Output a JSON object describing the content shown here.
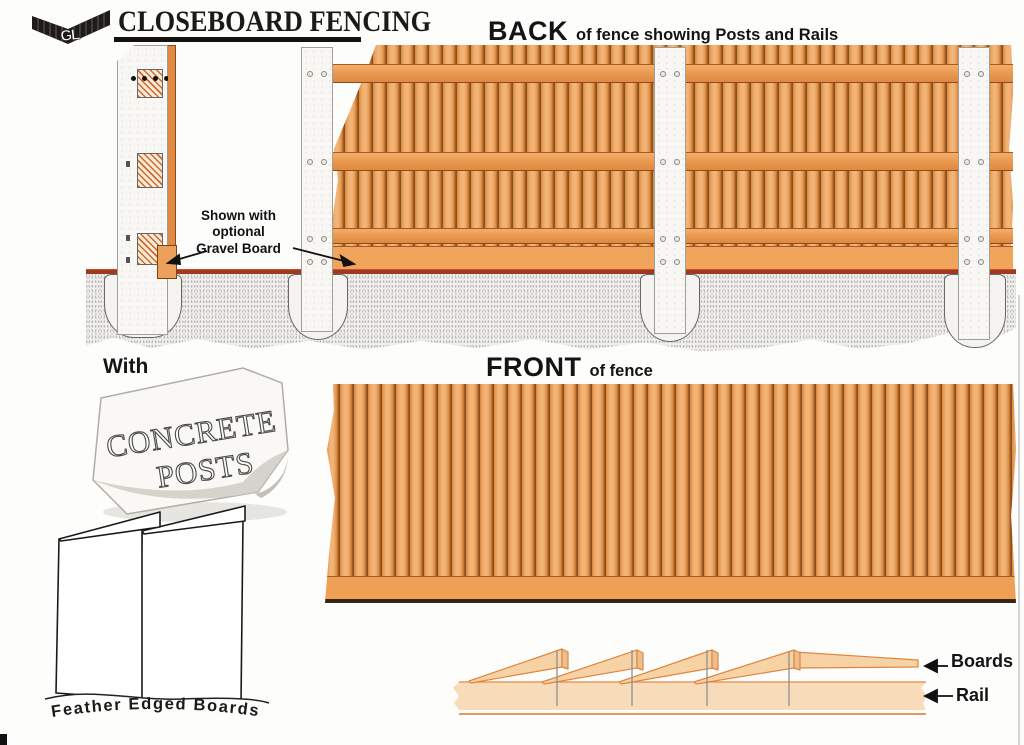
{
  "page": {
    "title": "CLOSEBOARD FENCING",
    "logo_monogram": "GL"
  },
  "back": {
    "heading": "BACK",
    "heading_rest": "of fence showing Posts and Rails",
    "annotation": {
      "line1": "Shown with",
      "line2": "optional",
      "line3": "Gravel Board"
    }
  },
  "front": {
    "heading": "FRONT",
    "heading_rest": "of fence"
  },
  "posts": {
    "with_label": "With",
    "block_line1": "CONCRETE",
    "block_line2": "POSTS"
  },
  "feather": {
    "caption": "Feather Edged Boards"
  },
  "detail": {
    "boards_label": "Boards",
    "rail_label": "Rail"
  },
  "colors": {
    "board_orange": "#E2954D",
    "rail_orange": "#EF9F58",
    "gravel_orange": "#EFA055",
    "post_white": "#F8F7F3",
    "ground_line_red": "#9C3A22",
    "detail_peach": "#F7D2A5"
  }
}
